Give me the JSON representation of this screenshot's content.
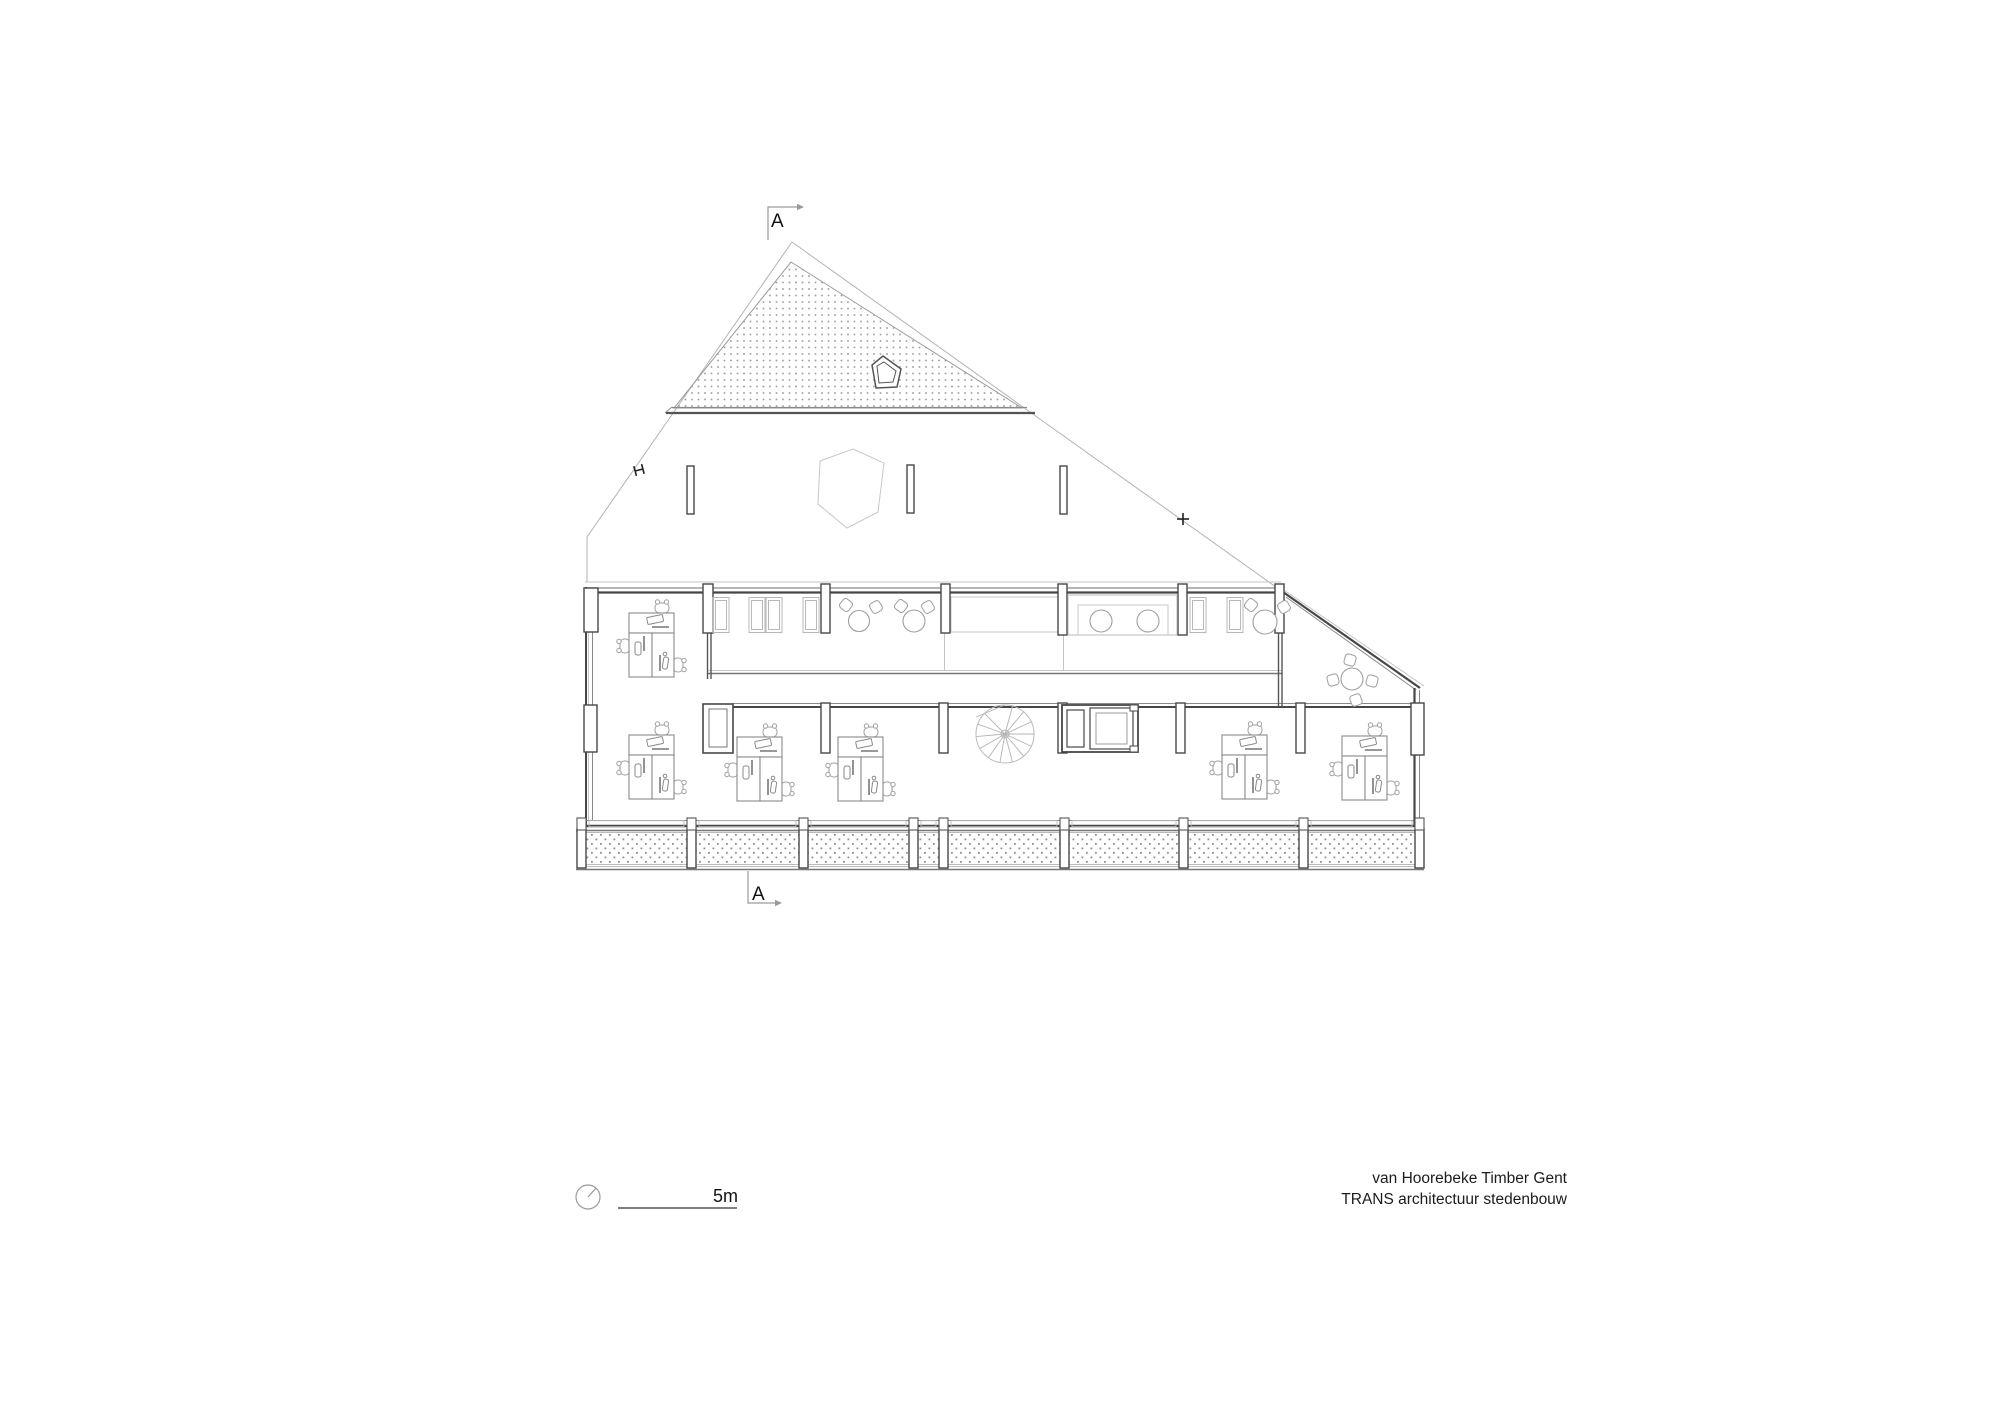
{
  "texts": {
    "section_marker_top": "A",
    "section_marker_bottom": "A",
    "scale_label": "5m",
    "title_line1": "van Hoorebeke Timber Gent",
    "title_line2": "TRANS architectuur stedenbouw"
  },
  "colors": {
    "background": "#ffffff",
    "wall_dark": "#474747",
    "line_medium": "#8a8a8a",
    "line_light": "#c4c4c4",
    "hatch_dot": "#9a9a9a",
    "text": "#1c1c1c"
  },
  "drawing_info": {
    "type": "architectural-floor-plan",
    "level": "attic-office-floor",
    "section_line": "A-A",
    "scale_bar_meters": 5,
    "furniture_counts": {
      "desk_workstations": 6,
      "round_tables": 6,
      "spiral_staircase": 1,
      "elevator": 1,
      "roof_window": 1,
      "balcony_panels": 8
    }
  },
  "plan": {
    "columns": [
      [
        584,
        588,
        14,
        44
      ],
      [
        584,
        705,
        13,
        47
      ],
      [
        703,
        584,
        10,
        49
      ],
      [
        821,
        584,
        9,
        49
      ],
      [
        941,
        584,
        9,
        49
      ],
      [
        1058,
        584,
        9,
        51
      ],
      [
        1178,
        584,
        9,
        51
      ],
      [
        1275,
        584,
        9,
        49
      ],
      [
        821,
        703,
        9,
        50
      ],
      [
        939,
        703,
        9,
        50
      ],
      [
        1058,
        703,
        9,
        50
      ],
      [
        1176,
        703,
        9,
        50
      ],
      [
        1296,
        703,
        9,
        50
      ],
      [
        1411,
        703,
        13,
        52
      ]
    ],
    "balcony_posts": [
      577,
      687,
      799,
      909,
      939,
      1060,
      1179,
      1299,
      1415
    ],
    "window_panes": [
      713,
      749,
      766,
      803,
      1190,
      1227
    ],
    "desks": [
      [
        629,
        613
      ],
      [
        629,
        735
      ],
      [
        737,
        737
      ],
      [
        838,
        737
      ],
      [
        1222,
        735
      ],
      [
        1342,
        736
      ]
    ],
    "round_tables": [
      [
        859,
        621,
        10.5
      ],
      [
        914,
        621,
        11
      ],
      [
        1265,
        622,
        12
      ],
      [
        1352,
        679,
        11
      ],
      [
        1101,
        621,
        11
      ],
      [
        1148,
        621,
        11
      ]
    ],
    "side_chairs": [
      [
        846,
        605,
        38
      ],
      [
        876,
        607,
        -30
      ],
      [
        901,
        606,
        38
      ],
      [
        928,
        607,
        -30
      ],
      [
        1251,
        605,
        38
      ],
      [
        1284,
        607,
        -30
      ],
      [
        1350,
        660,
        15
      ],
      [
        1333,
        680,
        75
      ],
      [
        1372,
        681,
        -75
      ],
      [
        1356,
        700,
        160
      ]
    ],
    "attic_stubs": [
      [
        687,
        466
      ],
      [
        907,
        465
      ],
      [
        1060,
        466
      ]
    ],
    "spiral_stair": {
      "cx": 1005,
      "cy": 734,
      "r": 29
    }
  }
}
